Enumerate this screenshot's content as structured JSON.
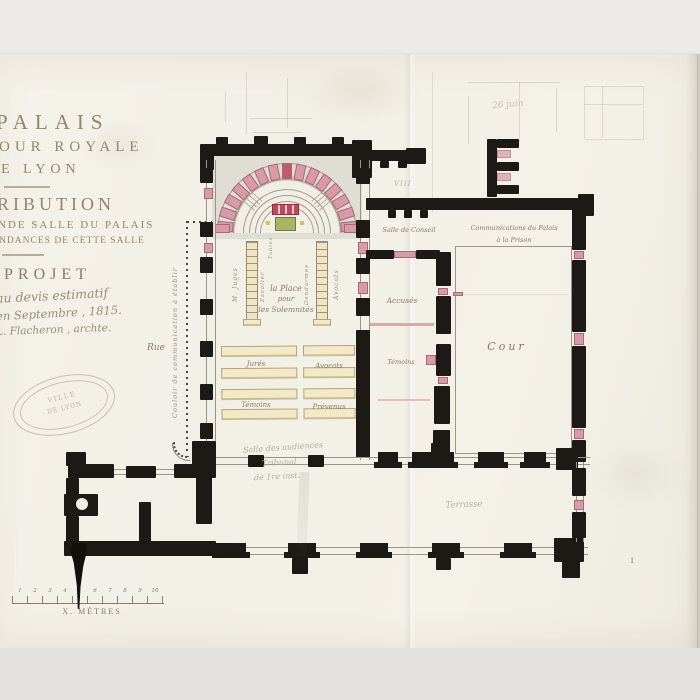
{
  "colors": {
    "paper": "#f3f0e8",
    "ink_black": "#1d1a16",
    "sepia_text": "#92826c",
    "pink_masonry": "#d89aa6",
    "green_table": "#aab465",
    "bench_cream": "#f3e9c9",
    "pencil": "#b3ad9f"
  },
  "title_block": {
    "line1": "PALAIS",
    "line2": "COUR ROYALE",
    "line3": "DE LYON",
    "line4": "TRIBUTION",
    "line5": "ANDE SALLE DU PALAIS",
    "line6": "PENDANCES DE CETTE SALLE",
    "project": "PROJET",
    "note1": "au devis estimatif",
    "note2": "en Septembre , 1815.",
    "note3": "L. Flacheron , archte."
  },
  "stamp": {
    "line1": "VILLE",
    "line2": "DE LYON"
  },
  "street_label": "Rue",
  "corridor_label": "Couloir de communication à établir",
  "hall": {
    "place_line1": "la Place",
    "place_line2": "pour",
    "place_line3": "les Solemnités",
    "tribune_left_outer": "M. Juges",
    "tribune_left_inner": "Escalier",
    "tribune_right_inner": "Gendarmes",
    "tribune_right_outer": "Avocats",
    "bureau_label": "Tables",
    "bench_row1_left": "Jurés",
    "bench_row1_right": "Avocats",
    "bench_row2_left": "Témoins",
    "bench_row2_right": "Prévenus"
  },
  "rooms": {
    "salle_conseil": "Salle de Conseil",
    "communications_line1": "Communications du Palais",
    "communications_line2": "à la Prison",
    "accuses": "Accusés",
    "temoins": "Témoins",
    "cour": "Cour",
    "terrasse": "Terrasse"
  },
  "pencil_notes": {
    "date": "26 juin",
    "roman": "VIII",
    "salle_line1": "Salle des audiences",
    "salle_line2": "Tribunal",
    "salle_line3": "de 1re inst."
  },
  "scale_bar": {
    "ticks": [
      "1",
      "2",
      "3",
      "4",
      "5",
      "6",
      "7",
      "8",
      "9",
      "10"
    ],
    "label": "X. MÈTRES"
  },
  "page_number": "1"
}
